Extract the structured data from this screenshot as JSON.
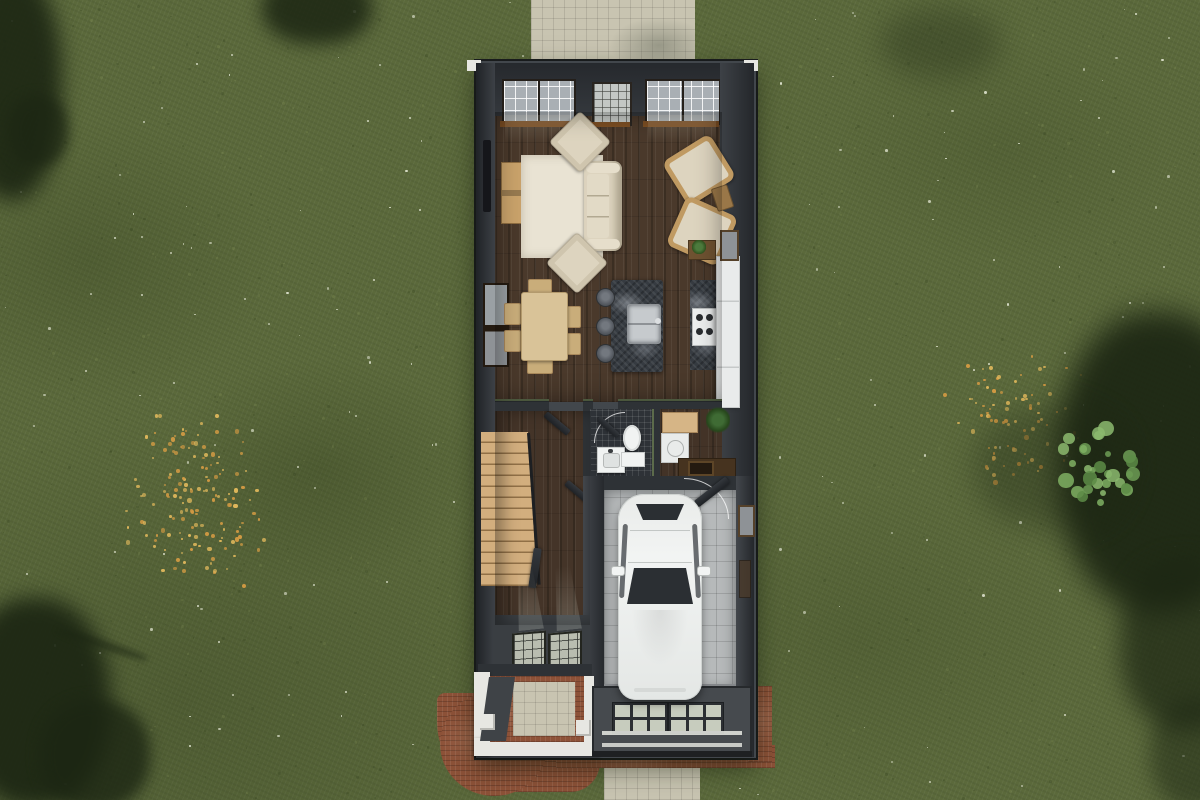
{
  "meta": {
    "description": "Overhead 3D cutaway rendering of a narrow single-family house floor plan on a grassy lot",
    "view": "top-down aerial"
  },
  "colors": {
    "grass_base": "#5b693b",
    "tree_shadow": "#1c2613",
    "bush_green": "#74a35c",
    "flower_orange": "#d29a43",
    "flower_gold": "#e0b85c",
    "speckle_white": "#dfe3cf",
    "concrete": "#c8c4b1",
    "wall_dark": "#2e3236",
    "wall_face": "#42474c",
    "trim_white": "#e9eae5",
    "wood_floor": "#4a392b",
    "rug_cream": "#e9e3d3",
    "upholstery": "#ddd4bf",
    "wicker_tan": "#c09a62",
    "dining_wood": "#d9c398",
    "granite_dark": "#363b41",
    "steel": "#c6cacd",
    "stool_gray": "#565b62",
    "cabinet_white": "#e9ebeb",
    "stair_wood": "#d2ae7e",
    "tile_dark": "#2e3237",
    "porcelain": "#f1f3f2",
    "bench_tan": "#d6b586",
    "counter_brown": "#46331f",
    "plant_green": "#3a6132",
    "garage_floor": "#b6b9ba",
    "car_white": "#f2f4f3",
    "glass_dark": "#2b2f33",
    "porch_white": "#e7e7e2",
    "brick_red": "#8d5238",
    "garage_door_gray": "#464a4e",
    "door_pane": "#c7ccbe",
    "sill_amber": "#7c4e23",
    "window_glass": "#a9afb4",
    "window_frame": "#241f1a",
    "entry_floor": "#3a3e42",
    "wall_top_green": "#5c6b4b"
  },
  "scene": {
    "setting": "lawn with wildflower patches, tree shadows at the corners, bright bush on the right",
    "structures": {
      "rear_patio_pad": "concrete pad at top of lot",
      "street_pad": "concrete walk at bottom of lot",
      "porch": "front porch with white frame, two posts, brick and concrete paving",
      "brick_patio": "rounded brick landing at lower-left of porch",
      "brick_apron": "brick border surrounding garage front"
    },
    "rooms": [
      "living-room",
      "kitchen-dining",
      "hallway",
      "bathroom",
      "mudroom",
      "garage",
      "entry",
      "porch"
    ],
    "objects": [
      "wall-tv",
      "media-console",
      "area-rug",
      "sofa",
      "armchair-top",
      "armchair-bottom",
      "accent-chair-upper",
      "accent-chair-lower",
      "side-table",
      "dining-table",
      "six-dining-chairs",
      "kitchen-island",
      "island-sink",
      "three-bar-stools",
      "range-stove",
      "dark-counter",
      "white-cabinets-refrigerator",
      "potted-plants",
      "staircase",
      "interior-doors",
      "toilet",
      "vanity-sink",
      "mudroom-bench",
      "washer",
      "utility-sink",
      "white-car",
      "garage-door-with-windows",
      "front-windows",
      "side-windows"
    ],
    "car": {
      "color": "white",
      "parked_in": "garage",
      "orientation": "facing street"
    },
    "lawn": {
      "white_speckles": {
        "count": 160
      },
      "grass_tufts": {
        "count": 700
      },
      "flower_patches": [
        {
          "cx": 195,
          "cy": 500,
          "rx": 78,
          "ry": 95,
          "count": 150
        },
        {
          "cx": 1015,
          "cy": 420,
          "rx": 75,
          "ry": 70,
          "count": 85
        }
      ],
      "bush": {
        "cx": 1096,
        "cy": 466,
        "r": 44,
        "count": 30
      }
    }
  }
}
